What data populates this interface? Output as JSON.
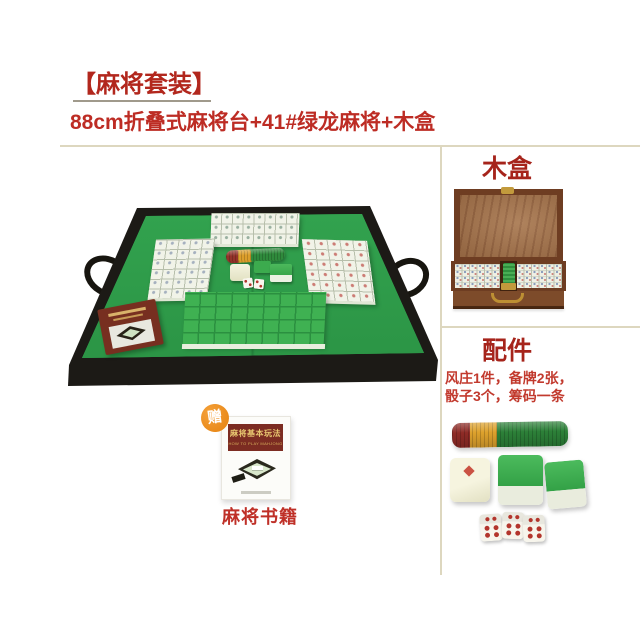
{
  "header": {
    "title": "【麻将套装】",
    "subtitle": "88cm折叠式麻将台+41#绿龙麻将+木盒"
  },
  "sections": {
    "wooden_box": {
      "heading": "木盒"
    },
    "accessories": {
      "heading": "配件",
      "desc_line1": "风庄1件，备牌2张，",
      "desc_line2": "骰子3个，筹码一条"
    },
    "gift": {
      "badge": "赠",
      "book_title": "麻将基本玩法",
      "book_subtitle": "HOW TO PLAY MAHJONG",
      "caption": "麻将书籍"
    }
  },
  "colors": {
    "accent_red": "#b2271d",
    "text_red": "#bf3028",
    "divider_tan": "#ddd7bf",
    "felt_green": "#2f9e4a",
    "tile_back_green": "#3fb152",
    "wood_brown": "#9e6d46",
    "badge_orange": "#e5820f",
    "book_maroon": "#7c2c22"
  }
}
